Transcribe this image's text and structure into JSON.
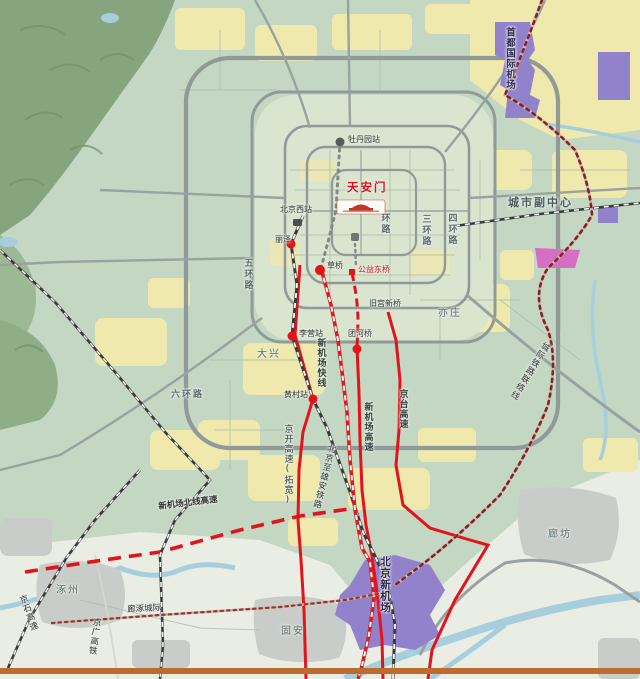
{
  "places": {
    "tiananmen": "天安门",
    "capital_airport": "首都国际机场",
    "city_subcenter": "城市副中心",
    "yizhuang": "亦庄",
    "daxing": "大兴",
    "new_airport": "北京新机场",
    "guan": "固安",
    "langfang": "廊坊",
    "zhuozhou": "涿州"
  },
  "stations": {
    "mudanyuan": "牡丹园站",
    "beijing_west": "北京西站",
    "lize": "丽泽",
    "caoqiao": "草桥",
    "gongyidongqiao": "公益东桥",
    "tuanheqiao": "团河桥",
    "liying": "李营站",
    "huangcun": "黄村站",
    "jiugong": "旧宫新桥"
  },
  "roads": {
    "ring2": "环路",
    "ring3": "三环路",
    "ring4": "四环路",
    "ring5": "五环路",
    "ring6": "六环路",
    "airport_express_line": "新机场快线",
    "airport_expressway": "新机场高速",
    "jingtai_expressway": "京台高速",
    "jingkai_expressway": "京开高速(拓宽)",
    "bj_xiongan_railway": "北京至雄安铁路",
    "airport_north_line": "新机场北线高速",
    "intercity_link_line": "城际铁路联络线",
    "langzhuo_intercity": "廊涿城际",
    "jingshi_expressway": "京石高速",
    "jingguang_hsr": "京广高铁"
  },
  "colors": {
    "land": "#c3d7c3",
    "urban_core": "#d9e5cf",
    "farmland_yellow": "#efe9ad",
    "water_blue": "#a6cedd",
    "mountain_green": "#86a57f",
    "airport_purple": "#9282cb",
    "magenta_zone": "#d46fc4",
    "city_gray": "#c9cdc9",
    "road_gray": "#939d9d",
    "highway_red": "#e2131b",
    "bottom_border": "#bd6b2e"
  }
}
